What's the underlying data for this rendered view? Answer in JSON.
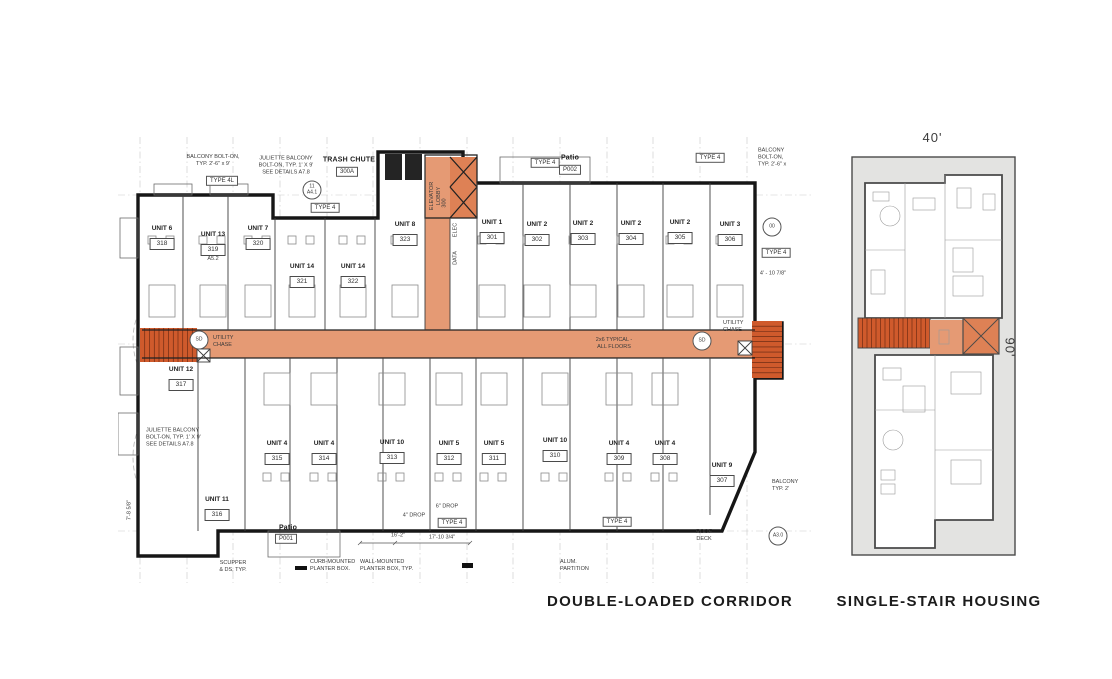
{
  "captions": {
    "left": "DOUBLE-LOADED CORRIDOR",
    "right": "SINGLE-STAIR HOUSING"
  },
  "colors": {
    "corridor": "#e59a74",
    "stair": "#cf5a2c",
    "elev": "#de8155",
    "panelgray": "#e3e3e1"
  },
  "left_plan": {
    "top_units": [
      {
        "name": "UNIT 6",
        "number": "318",
        "x": 162,
        "y": 225
      },
      {
        "name": "UNIT 13",
        "number": "319",
        "x": 213,
        "y": 231,
        "extra": "A5.2"
      },
      {
        "name": "UNIT 7",
        "number": "320",
        "x": 258,
        "y": 225
      },
      {
        "name": "UNIT 14",
        "number": "321",
        "x": 302,
        "y": 263
      },
      {
        "name": "UNIT 14",
        "number": "322",
        "x": 353,
        "y": 263
      },
      {
        "name": "UNIT 8",
        "number": "323",
        "x": 405,
        "y": 221
      },
      {
        "name": "UNIT 1",
        "number": "301",
        "x": 492,
        "y": 219
      },
      {
        "name": "UNIT 2",
        "number": "302",
        "x": 537,
        "y": 221
      },
      {
        "name": "UNIT 2",
        "number": "303",
        "x": 583,
        "y": 220
      },
      {
        "name": "UNIT 2",
        "number": "304",
        "x": 631,
        "y": 220
      },
      {
        "name": "UNIT 2",
        "number": "305",
        "x": 680,
        "y": 219
      },
      {
        "name": "UNIT 3",
        "number": "306",
        "x": 730,
        "y": 221
      }
    ],
    "bottom_units": [
      {
        "name": "UNIT 12",
        "number": "317",
        "x": 181,
        "y": 366,
        "nofurn": true
      },
      {
        "name": "UNIT 11",
        "number": "316",
        "x": 217,
        "y": 496,
        "nofurn": true
      },
      {
        "name": "UNIT 4",
        "number": "315",
        "x": 277,
        "y": 440
      },
      {
        "name": "UNIT 4",
        "number": "314",
        "x": 324,
        "y": 440
      },
      {
        "name": "UNIT 10",
        "number": "313",
        "x": 392,
        "y": 439
      },
      {
        "name": "UNIT 5",
        "number": "312",
        "x": 449,
        "y": 440
      },
      {
        "name": "UNIT 5",
        "number": "311",
        "x": 494,
        "y": 440
      },
      {
        "name": "UNIT 10",
        "number": "310",
        "x": 555,
        "y": 437
      },
      {
        "name": "UNIT 4",
        "number": "309",
        "x": 619,
        "y": 440
      },
      {
        "name": "UNIT 4",
        "number": "308",
        "x": 665,
        "y": 440
      },
      {
        "name": "UNIT 9",
        "number": "307",
        "x": 722,
        "y": 462,
        "nofurn": true
      }
    ],
    "annotations": [
      {
        "t": "BALCONY BOLT-ON,\nTYP. 2'-6\" x 9'",
        "x": 213,
        "y": 161
      },
      {
        "t": "TYPE 4L",
        "x": 222,
        "y": 181,
        "cls": "tag"
      },
      {
        "t": "JULIETTE BALCONY\nBOLT-ON, TYP. 1' X 9'\nSEE DETAILS A7.8",
        "x": 286,
        "y": 166
      },
      {
        "t": "TRASH CHUTE",
        "x": 349,
        "y": 160,
        "cls": "bold"
      },
      {
        "t": "300A",
        "x": 347,
        "y": 172,
        "cls": "tag"
      },
      {
        "t": "11\nA4.1",
        "x": 312,
        "y": 190,
        "cls": "circle"
      },
      {
        "t": "TYPE 4",
        "x": 325,
        "y": 208,
        "cls": "tag"
      },
      {
        "t": "TYPE 4",
        "x": 545,
        "y": 163,
        "cls": "tag"
      },
      {
        "t": "Patio",
        "x": 570,
        "y": 158,
        "cls": "bold"
      },
      {
        "t": "P002",
        "x": 570,
        "y": 170,
        "cls": "tag"
      },
      {
        "t": "TYPE 4",
        "x": 710,
        "y": 158,
        "cls": "tag"
      },
      {
        "t": "BALCONY\nBOLT-ON,\nTYP. 2'-6\" x",
        "x": 758,
        "y": 158,
        "align": "left"
      },
      {
        "t": "00",
        "x": 772,
        "y": 227,
        "cls": "circle"
      },
      {
        "t": "TYPE 4",
        "x": 776,
        "y": 253,
        "cls": "tag"
      },
      {
        "t": "4' - 10 7/8\"",
        "x": 773,
        "y": 274
      },
      {
        "t": "ELEVATOR\nLOBBY",
        "x": 436,
        "y": 196,
        "rot": -90
      },
      {
        "t": "300",
        "x": 445,
        "y": 203,
        "rot": -90
      },
      {
        "t": "ELEC",
        "x": 456,
        "y": 230,
        "rot": -90
      },
      {
        "t": "DATA",
        "x": 456,
        "y": 258,
        "rot": -90
      },
      {
        "t": "SD",
        "x": 199,
        "y": 340,
        "cls": "circle"
      },
      {
        "t": "UTILITY\nCHASE",
        "x": 213,
        "y": 342,
        "align": "left"
      },
      {
        "t": "SD",
        "x": 702,
        "y": 341,
        "cls": "circle"
      },
      {
        "t": "UTILITY\nCHASE",
        "x": 723,
        "y": 327,
        "align": "left"
      },
      {
        "t": "2x6 TYPICAL -\nALL FLOORS",
        "x": 614,
        "y": 344
      },
      {
        "t": "JULIETTE BALCONY\nBOLT-ON, TYP. 1' X 9'\nSEE DETAILS A7.8",
        "x": 146,
        "y": 438,
        "align": "left"
      },
      {
        "t": "Patio",
        "x": 288,
        "y": 528,
        "cls": "bold"
      },
      {
        "t": "P001",
        "x": 286,
        "y": 539,
        "cls": "tag"
      },
      {
        "t": "6\" DROP",
        "x": 447,
        "y": 507
      },
      {
        "t": "4\" DROP",
        "x": 414,
        "y": 516
      },
      {
        "t": "TYPE 4",
        "x": 452,
        "y": 523,
        "cls": "tag"
      },
      {
        "t": "TYPE 4",
        "x": 617,
        "y": 522,
        "cls": "tag"
      },
      {
        "t": "16'-2\"",
        "x": 398,
        "y": 536
      },
      {
        "t": "17'-10 3/4\"",
        "x": 442,
        "y": 538
      },
      {
        "t": "ROOF\nDECK",
        "x": 704,
        "y": 536
      },
      {
        "t": "BALCONY\nTYP. 2'",
        "x": 772,
        "y": 486,
        "align": "left"
      },
      {
        "t": "A3.0",
        "x": 778,
        "y": 536,
        "cls": "circle"
      },
      {
        "t": "SCUPPER\n& DS, TYP.",
        "x": 233,
        "y": 567
      },
      {
        "t": "CURB-MOUNTED\nPLANTER BOX.",
        "x": 310,
        "y": 566,
        "align": "left"
      },
      {
        "t": "WALL-MOUNTED\nPLANTER BOX, TYP.",
        "x": 360,
        "y": 566,
        "align": "left"
      },
      {
        "t": "ALUM.\nPARTITION",
        "x": 560,
        "y": 566,
        "align": "left"
      },
      {
        "t": "7'-8 5/8\"",
        "x": 130,
        "y": 510,
        "rot": -90
      }
    ]
  },
  "right_plan": {
    "top_dim": "40'",
    "side_dim": "90'"
  }
}
